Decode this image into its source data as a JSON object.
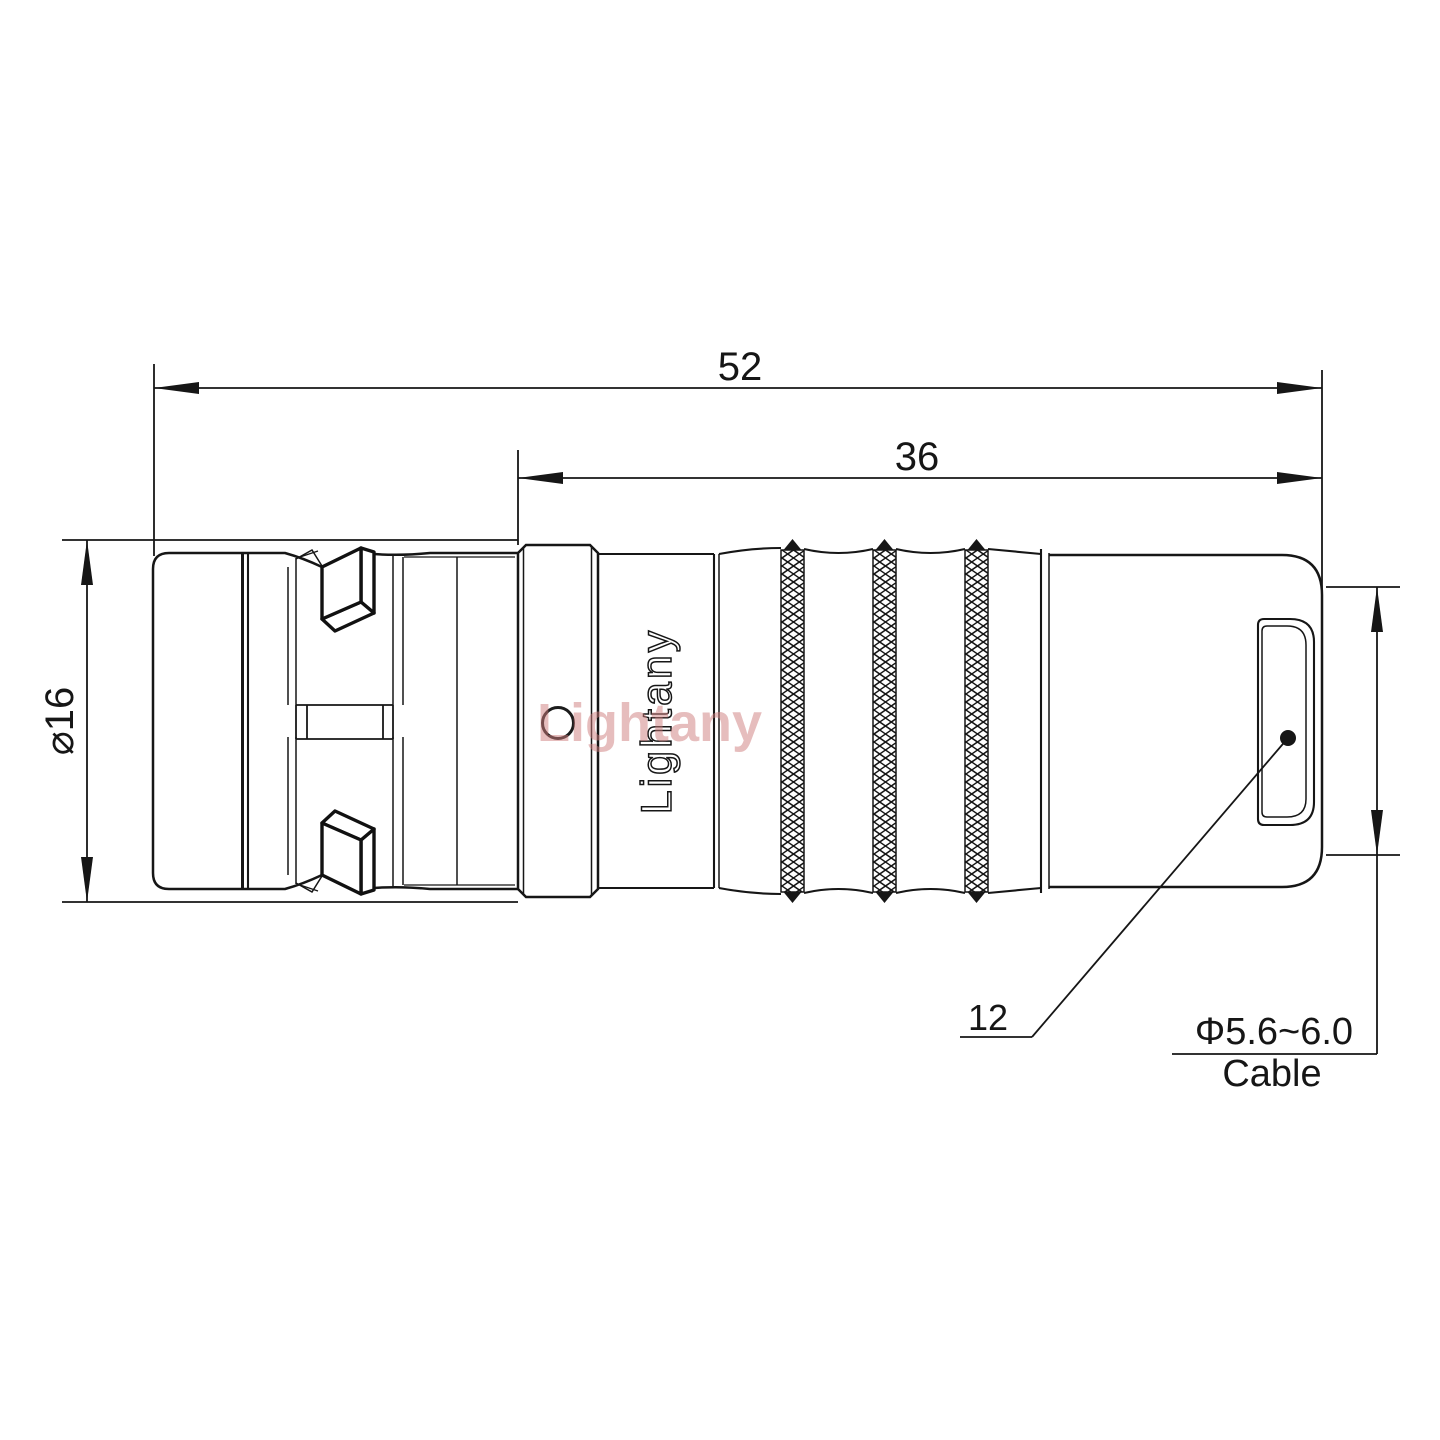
{
  "drawing": {
    "dimensions": {
      "overall_length": "52",
      "rear_section_length": "36",
      "front_diameter": "⌀16",
      "rear_diameter": "12",
      "cable_range": "Φ5.6~6.0",
      "cable_word": "Cable"
    },
    "branding": {
      "engraving": "Lightany",
      "watermark": "Lightany"
    },
    "colors": {
      "line": "#161616",
      "watermark_red": "#cf7d7d",
      "background": "#ffffff"
    }
  }
}
